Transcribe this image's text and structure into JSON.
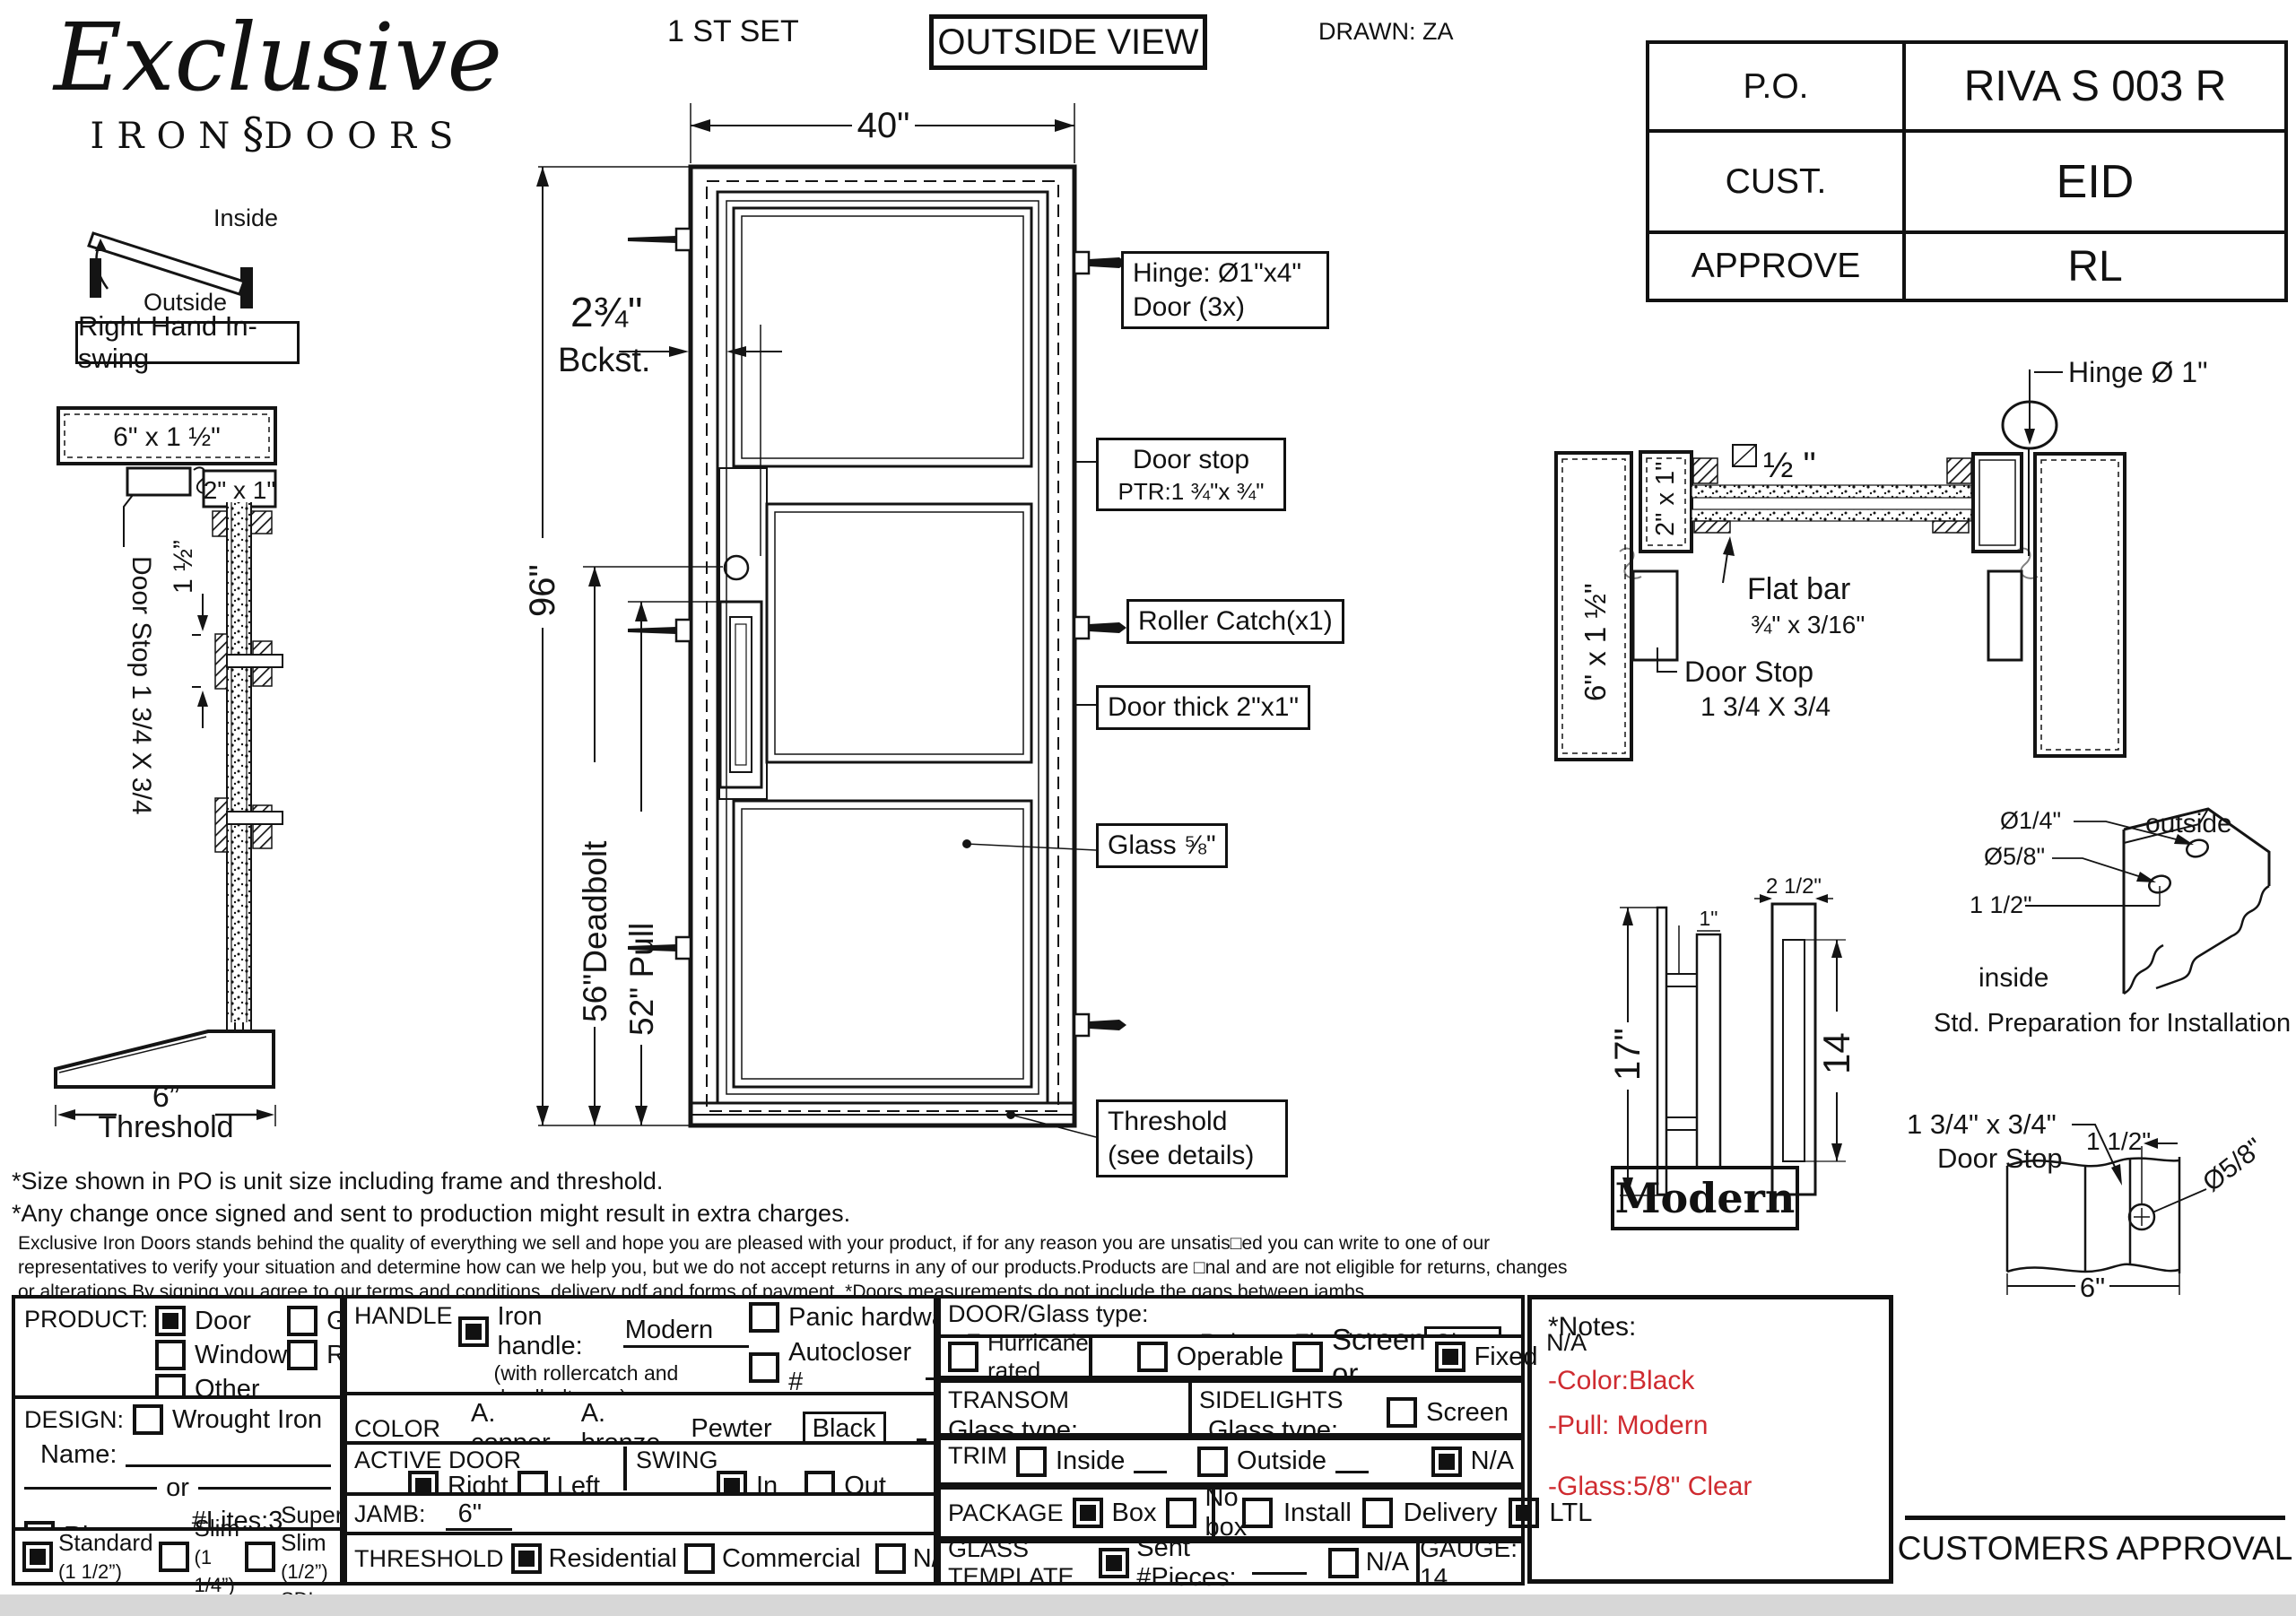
{
  "header": {
    "set": "1 ST SET",
    "view": "OUTSIDE VIEW",
    "drawn": "DRAWN: ZA"
  },
  "logo": {
    "brand": "Exclusive",
    "sub1": "IRON",
    "fleuron": "§",
    "sub2": "DOORS"
  },
  "info_table": {
    "rows": [
      {
        "label": "P.O.",
        "value": "RIVA S 003 R"
      },
      {
        "label": "CUST.",
        "value": "EID"
      },
      {
        "label": "APPROVE",
        "value": "RL"
      }
    ]
  },
  "swing": {
    "inside": "Inside",
    "outside": "Outside",
    "caption": "Right Hand In-swing"
  },
  "jamb_section": {
    "top": "6\" x 1 ½\"",
    "tube": "2\" x 1\"",
    "gap": "1 ½”",
    "door_stop": "Door Stop 1 3/4 X 3/4",
    "width": "6”",
    "caption": "Threshold"
  },
  "door": {
    "width": "40\"",
    "height": "96\"",
    "backset": "2¾\"",
    "backset_label": "Bckst.",
    "deadbolt": "56\"Deadbolt",
    "pull": "52\" Pull",
    "callouts": {
      "hinge1": "Hinge: Ø1\"x4\"",
      "hinge2": "Door (3x)",
      "stop1": "Door stop",
      "stop2": "PTR:1 ¾\"x ¾\"",
      "roller": "Roller Catch(x1)",
      "thick": "Door thick 2\"x1\"",
      "glass": "Glass ⅝\"",
      "threshold1": "Threshold",
      "threshold2": "(see details)"
    }
  },
  "section": {
    "hinge": "Hinge  Ø 1\"",
    "half": "½ \"",
    "tube": "2\" x 1\"",
    "jamb": "6\" x 1 ½\"",
    "flatbar1": "Flat bar",
    "flatbar2": "¾\" x 3/16\"",
    "stop1": "Door Stop",
    "stop2": "1 3/4 X 3/4"
  },
  "handle": {
    "h": "17\"",
    "w1": "1\"",
    "w2": "2 1/2\"",
    "slot": "14",
    "name": "Modern"
  },
  "prep": {
    "d1": "Ø1/4\"",
    "d2": "Ø5/8\"",
    "off": "1 1/2\"",
    "out": "outside",
    "in": "inside",
    "caption": "Std. Preparation for Installation"
  },
  "stop_detail": {
    "size": "1 3/4\" x 3/4\"",
    "name": "Door Stop",
    "off": "1 1/2\"",
    "dia": "Ø5/8\"",
    "width": "6\""
  },
  "disclaimer": {
    "l1": "*Size shown in PO is unit size including frame and threshold.",
    "l2": "*Any change once signed and sent to production might result in extra charges.",
    "p1": "Exclusive Iron Doors stands behind the quality of everything we sell and hope you are pleased with your product, if for any reason you are unsatis□ed you can write to one of our",
    "p2": "representatives to verify your situation and determine how can we help you, but we do not accept returns in any of our products.Products are □nal and are not eligible for returns, changes",
    "p3": "or alterations.By signing you agree to our terms and conditions, delivery pdf and forms of payment. *Doors measurements do not include the gaps between jambs"
  },
  "form": {
    "product": {
      "label": "PRODUCT:",
      "door": {
        "label": "Door",
        "checked": true
      },
      "gate": {
        "label": "Gate",
        "checked": false
      },
      "window": {
        "label": "Window",
        "checked": false
      },
      "railing": {
        "label": "Railling",
        "checked": false
      },
      "other": {
        "label": "Other",
        "checked": false
      }
    },
    "design": {
      "label": "DESIGN:",
      "wrought": {
        "label": "Wrought Iron",
        "checked": false
      },
      "name_label": "Name:",
      "or": "or",
      "riva": {
        "label": "Riva",
        "checked": true
      },
      "lites": "#Lites:3  door",
      "standard": {
        "label": "Standard",
        "sub": "(1 1/2”)",
        "checked": true
      },
      "slim": {
        "label": "Slim",
        "sub": "(1 1/4”)",
        "checked": false
      },
      "superslim": {
        "label": "Super Slim",
        "sub": "(1/2”) SDL",
        "checked": false
      }
    },
    "handle": {
      "label": "HANDLE",
      "iron": {
        "label": "Iron handle:",
        "value": "Modern",
        "checked": true
      },
      "iron_sub": "(with rollercatch and deadbolt prep)",
      "american": {
        "label": "American standard double boring",
        "checked": false
      },
      "other": {
        "label": "Other:",
        "checked": false
      },
      "panic": {
        "label": "Panic hardware",
        "checked": false
      },
      "autocloser": {
        "label": "Autocloser #",
        "checked": false
      },
      "pbar": {
        "label": "P. Bar #",
        "checked": false
      }
    },
    "color": {
      "label": "COLOR",
      "copper": "A. copper",
      "bronze": "A. bronze",
      "pewter": "Pewter",
      "black": "Black"
    },
    "active": {
      "label": "ACTIVE DOOR",
      "right": {
        "label": "Right",
        "checked": true
      },
      "left": {
        "label": "Left",
        "checked": false
      }
    },
    "swing": {
      "label": "SWING",
      "in": {
        "label": "In",
        "checked": true
      },
      "out": {
        "label": "Out",
        "checked": false
      }
    },
    "jamb": {
      "label": "JAMB:",
      "value": "6\""
    },
    "threshold": {
      "label": "THRESHOLD",
      "residential": {
        "label": "Residential",
        "checked": true
      },
      "commercial": {
        "label": "Commercial",
        "checked": false
      },
      "na": {
        "label": "N/A",
        "checked": false
      }
    },
    "glass": {
      "label": "DOOR/Glass type:",
      "frost": "Frost",
      "aquatex": "Aquatex",
      "rain": "Rain",
      "flemish": "Flemish",
      "clear": "Clear",
      "na": "N/A"
    },
    "hurricane": {
      "label": "Hurricane rated",
      "checked": false
    },
    "operable": {
      "label": "Operable",
      "checked": false
    },
    "screen_or": {
      "label": "Screen or",
      "checked": false
    },
    "fixed": {
      "label": "Fixed",
      "checked": true
    },
    "transom": {
      "label": "TRANSOM",
      "glass_label": "Glass type:"
    },
    "sidelights": {
      "label": "SIDELIGHTS",
      "glass_label": "Glass type:",
      "screen": {
        "label": "Screen",
        "checked": false
      }
    },
    "trim": {
      "label": "TRIM",
      "inside": {
        "label": "Inside",
        "checked": false
      },
      "outside": {
        "label": "Outside",
        "checked": false
      },
      "na": {
        "label": "N/A",
        "checked": true
      }
    },
    "package": {
      "label": "PACKAGE",
      "box": {
        "label": "Box",
        "checked": true
      },
      "nobox": {
        "label": "No box",
        "checked": false
      },
      "install": {
        "label": "Install",
        "checked": false
      },
      "delivery": {
        "label": "Delivery",
        "checked": false
      },
      "ltl": {
        "label": "LTL",
        "checked": true
      }
    },
    "template": {
      "label": "GLASS TEMPLATE",
      "sent": {
        "label": "Sent #Pieces:",
        "checked": true
      },
      "na": {
        "label": "N/A",
        "checked": false
      }
    },
    "gauge": "GAUGE: 14"
  },
  "side_notes": {
    "title": "*Notes:",
    "items": [
      "-Color:Black",
      "-Pull: Modern",
      "-Glass:5/8\" Clear"
    ]
  },
  "approval": "CUSTOMERS APPROVAL",
  "colors": {
    "note_red": "#cf2b30"
  }
}
